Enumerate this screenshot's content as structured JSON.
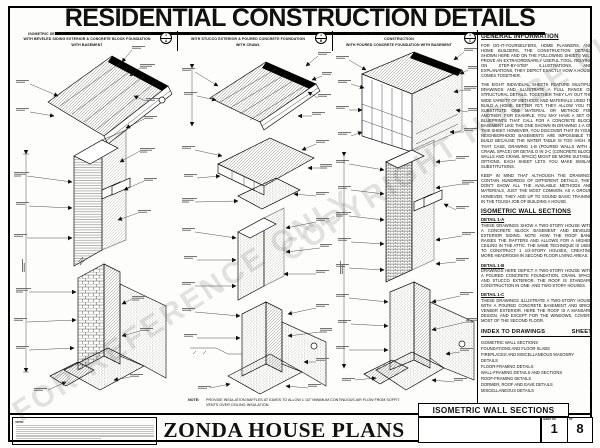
{
  "page": {
    "title": "RESIDENTIAL CONSTRUCTION DETAILS"
  },
  "watermarks": {
    "w1": "FOR REFERENCE ONLY",
    "w2": "COPYRIGHT HOUSE PLANS"
  },
  "columns": [
    {
      "line1": "ISOMETRIC SECTION OF TYPICAL FRAME WALL CONSTRUCTION",
      "line2": "WITH BEVELED SIDING EXTERIOR & CONCRETE BLOCK FOUNDATION",
      "line3": "WITH BASEMENT",
      "marker": {
        "num": "1",
        "letter": "A"
      }
    },
    {
      "line1": "ISOMETRIC SECTION OF TYPICAL FRAME WALL CONSTRUCTION",
      "line2": "WITH STUCCO EXTERIOR & POURED CONCRETE FOUNDATION",
      "line3": "WITH CRAWL",
      "marker": {
        "num": "1",
        "letter": "B"
      }
    },
    {
      "line1": "ISOMETRIC SECTION OF TYPICAL BRICK VENEER WALL CONSTRUCTION",
      "line2": "WITH POURED CONCRETE FOUNDATION WITH BASEMENT",
      "line3": "",
      "marker": {
        "num": "1",
        "letter": "C"
      }
    }
  ],
  "info": {
    "general": {
      "heading": "GENERAL INFORMATION",
      "p1": "FOR DO-IT-YOURSELFERS, HOME PLANNERS, AND HOME BUILDERS, THE CONSTRUCTION DETAILS SHOWN HERE AND ON THE FOLLOWING SHEETS WILL PROVE AN EXTRAORDINARILY USEFUL TOOL. RELYING ON STEP-BY-STEP ILLUSTRATIONS, AND EXPLANATIONS, THEY DEPICT EXACTLY HOW A HOUSE COMES TOGETHER.",
      "p2": "THE EIGHT INDIVIDUAL SHEETS FEATURE MULTIPLE DRAWINGS AND ILLUSTRATE A FULL RANGE OF STRUCTURAL DETAILS. TOGETHER THEY LAY OUT THE WIDE VARIETY OF METHODS AND MATERIALS USED TO BUILD A HOME. BETTER YET, THEY ALLOW YOU TO SUBSTITUTE ONE MATERIAL OR METHOD FOR ANOTHER. FOR EXAMPLE, YOU MAY HAVE A SET OF BLUEPRINTS THAT CALL FOR A CONCRETE BLOCK BASEMENT LIKE THE ONE SHOWN IN DRAWING 1-A ON THIS SHEET. HOWEVER, YOU DISCOVER THAT IN YOUR NEIGHBORHOOD BASEMENTS ARE IMPOSSIBLE TO BUILD BECAUSE THE WATER TABLE IS TOO HIGH. IN THAT CASE, DRAWING 1-B (POURED WALLS WITH A CRAWL SPACE) OR DETAIL D IN 2-C (CONCRETE BLOCK WALLS AND CRAWL SPACE) MIGHT BE MORE SUITABLE OPTIONS. EACH SHEET LETS YOU MAKE SIMILAR SUBSTITUTIONS.",
      "p3": "KEEP IN MIND THAT ALTHOUGH THE DRAWINGS CONTAIN HUNDREDS OF DIFFERENT DETAILS, THEY DON'T SHOW ALL THE AVAILABLE METHODS AND MATERIALS, JUST THE MOST COMMON. AS A GROUP, HOWEVER, THEY ADD UP TO SOUND BASIC TRAINING IN THE TOUGH JOB OF BUILDING A HOUSE."
    },
    "sections": {
      "heading": "ISOMETRIC WALL SECTIONS",
      "d1": {
        "label": "DETAIL 1-A",
        "text": "THESE DRAWINGS SHOW A TWO-STORY HOUSE WITH A CONCRETE BLOCK BASEMENT AND BEVELED EXTERIOR SIDING. NOTE HOW THE ROOF BAND RAISES THE RAFTERS AND ALLOWS FOR A HIGHER CEILING IN THE ATTIC. THE SAME TECHNIQUE IS USED TO CONSTRUCT 1 1/2-STORY HOUSES, CREATING MORE HEADROOM IN SECOND FLOOR LIVING AREAS."
      },
      "d2": {
        "label": "DETAIL 1-B",
        "text": "DRAWINGS HERE DEPICT A TWO-STORY HOUSE WITH A POURED CONCRETE FOUNDATION, CRAWL SPACE AND STUCCO EXTERIOR. THE ROOF IS STANDARD CONSTRUCTION IN ONE- AND TWO-STORY HOUSES."
      },
      "d3": {
        "label": "DETAIL 1-C",
        "text": "THESE DRAWINGS ILLUSTRATE A TWO-STORY HOUSE WITH A POURED CONCRETE BASEMENT AND BRICK VENEER EXTERIOR. HERE THE ROOF IS A MANSARD DESIGN, AND EXCEPT FOR THE WINDOWS, COVERS MOST OF THE SECOND FLOOR."
      }
    }
  },
  "index": {
    "heading": "INDEX TO DRAWINGS",
    "sheet_label": "SHEET",
    "entries": [
      {
        "label": "ISOMETRIC WALL SECTIONS",
        "sheet": "1"
      },
      {
        "label": "FOUNDATIONS AND FLOOR SLABS",
        "sheet": "2"
      },
      {
        "label": "FIREPLACES AND MISCELLANEOUS MASONRY DETAILS",
        "sheet": "3"
      },
      {
        "label": "FLOOR-FRAMING DETAILS",
        "sheet": "4"
      },
      {
        "label": "WALL-FRAMING DETAILS AND SECTIONS",
        "sheet": "5"
      },
      {
        "label": "ROOF-FRAMING DETAILS",
        "sheet": "6"
      },
      {
        "label": "DORMER, ROOF AND EAVE DETAILS",
        "sheet": "7"
      },
      {
        "label": "MISCELLANEOUS DETAILS",
        "sheet": "8"
      }
    ]
  },
  "note": {
    "label": "NOTE:",
    "text": "PROVIDE INSULATION BAFFLES AT EAVES TO ALLOW 1 1/2\" MINIMUM CONTINUOUS AIR FLOW FROM SOFFIT VENTS OVER CEILING INSULATION."
  },
  "footer": {
    "fine_print_label": "NOTE:",
    "brand": "ZONDA HOUSE PLANS"
  },
  "titleblock": {
    "sheet_title": "ISOMETRIC WALL SECTIONS",
    "sheet_no_label": "SHEET NO",
    "sheet_no": "1",
    "of_label": "OF",
    "of_no": "8"
  }
}
